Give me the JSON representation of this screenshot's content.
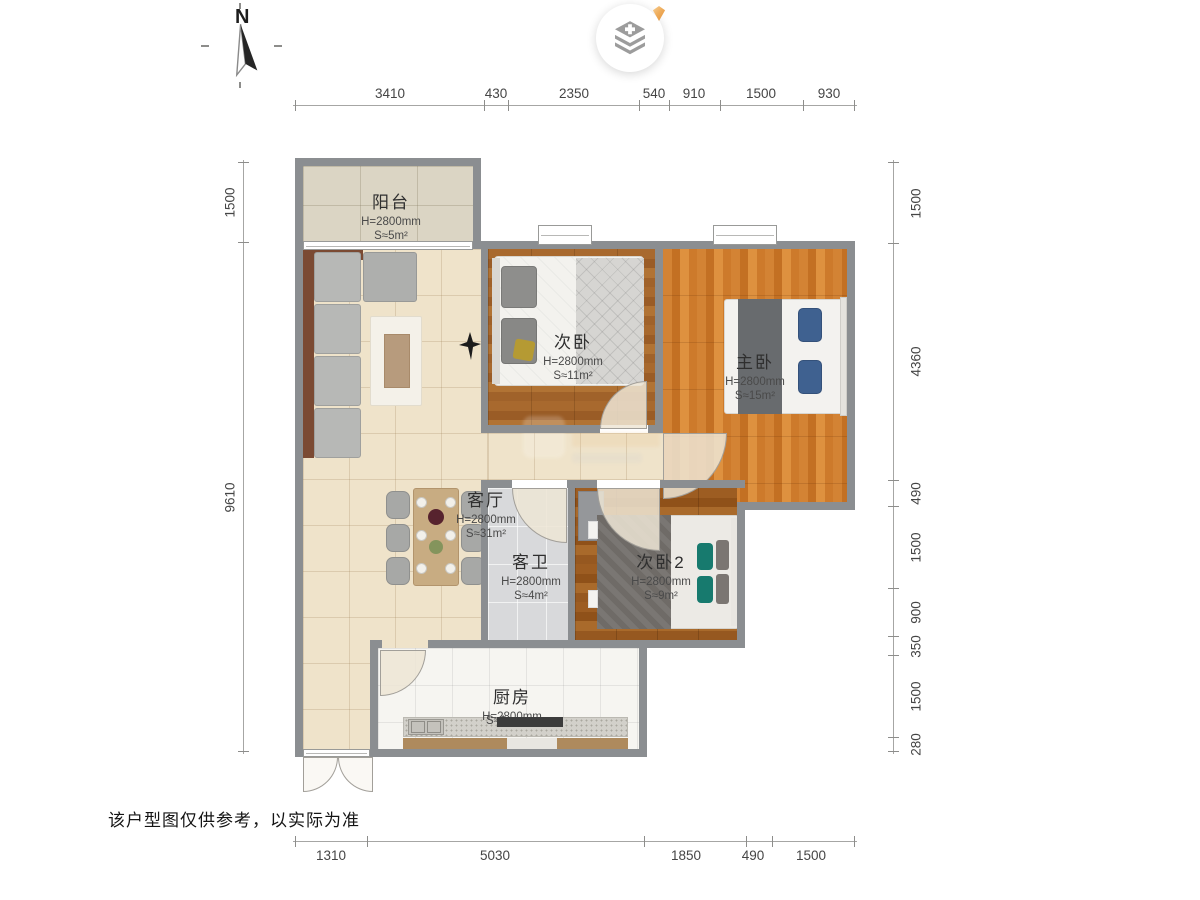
{
  "compass": {
    "label": "N"
  },
  "icons": {
    "logo": "layers-plus-icon",
    "badge": "gem-icon",
    "compass": "compass-needle-icon",
    "living_decor": "bird-icon"
  },
  "rooms": [
    {
      "name": "阳台",
      "height": "H=2800mm",
      "area": "S≈5m²"
    },
    {
      "name": "次卧",
      "height": "H=2800mm",
      "area": "S≈11m²"
    },
    {
      "name": "主卧",
      "height": "H=2800mm",
      "area": "S≈15m²"
    },
    {
      "name": "客厅",
      "height": "H=2800mm",
      "area": "S≈31m²"
    },
    {
      "name": "客卫",
      "height": "H=2800mm",
      "area": "S≈4m²"
    },
    {
      "name": "次卧2",
      "height": "H=2800mm",
      "area": "S≈9m²"
    },
    {
      "name": "厨房",
      "height": "H=2800mm",
      "area": "S≈1"
    }
  ],
  "dimensions": {
    "top": [
      "3410",
      "430",
      "2350",
      "540",
      "910",
      "1500",
      "930"
    ],
    "bottom": [
      "1310",
      "5030",
      "1850",
      "490",
      "1500"
    ],
    "left": [
      "1500",
      "9610"
    ],
    "right": [
      "1500",
      "4360",
      "490",
      "1500",
      "900",
      "350",
      "1500",
      "280"
    ]
  },
  "disclaimer": "该户型图仅供参考，以实际为准",
  "colors": {
    "wall": "#8b8e91",
    "living_floor": "#efe3ca",
    "balcony_floor": "#dbd5c4",
    "bedroom_wood": "#a8692e",
    "master_wood": "#d28231",
    "bedroom2_wood": "#9d5d22",
    "bath_tile": "#d8d9db",
    "kitchen_floor": "#f6f5f1",
    "accent_orange": "#e9973f"
  }
}
